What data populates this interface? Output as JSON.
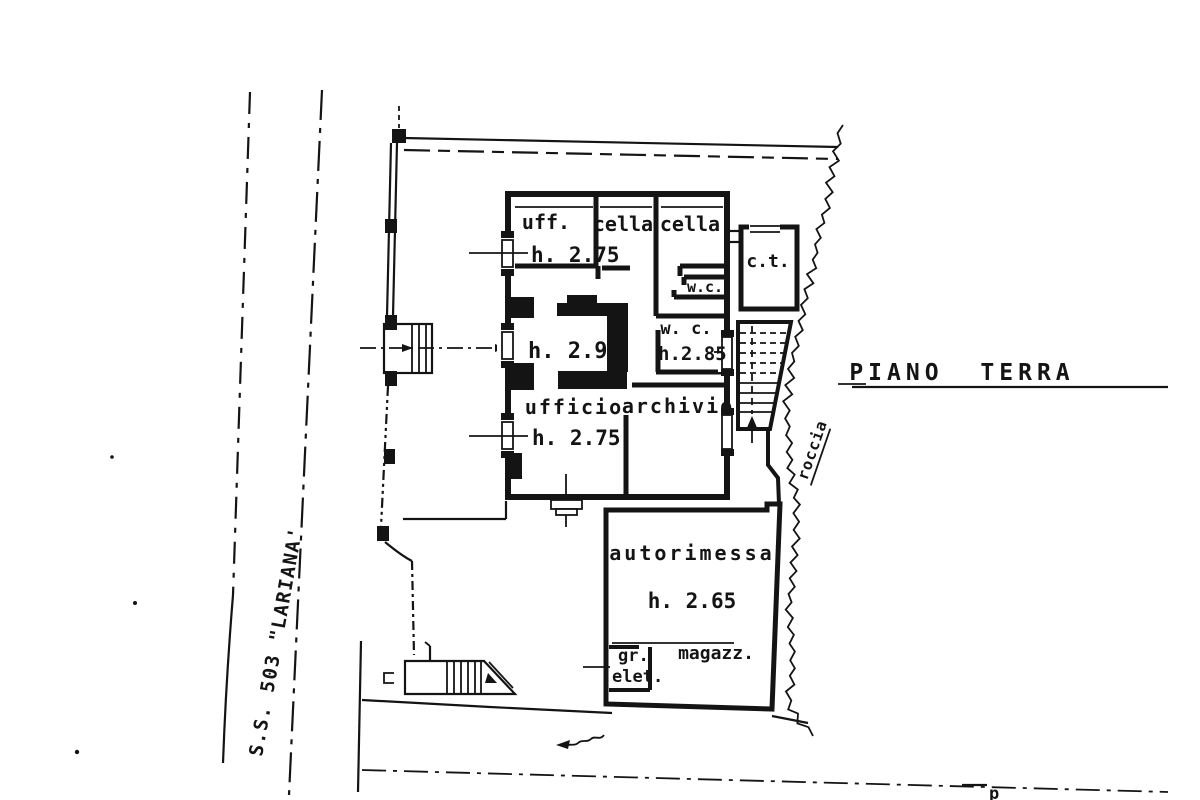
{
  "plan": {
    "title": "PIANO TERRA",
    "road_label": "S.S. 503 \"LARIANA'",
    "rock_label": "roccia",
    "corner_mark": "p",
    "colors": {
      "ink": "#141414",
      "paper": "#ffffff"
    },
    "rooms": {
      "uff": {
        "label": "uff.",
        "height": "h. 2.75"
      },
      "cella_left": {
        "label": "cella"
      },
      "cella_right": {
        "label": "cella"
      },
      "ct": {
        "label": "c.t."
      },
      "wc_top": {
        "label": "w.c."
      },
      "wc_mid": {
        "label": "w. c.",
        "height": "h.2.85"
      },
      "central_height": "h. 2.95",
      "ufficio": {
        "label": "ufficio",
        "height": "h. 2.75"
      },
      "archivio": {
        "label": "archivio"
      },
      "autorimessa": {
        "label": "autorimessa",
        "height": "h. 2.65"
      },
      "gruppo_elettrogeno": {
        "line1": "gr.",
        "line2": "elet."
      },
      "magazzino": {
        "label": "magazz."
      }
    }
  }
}
